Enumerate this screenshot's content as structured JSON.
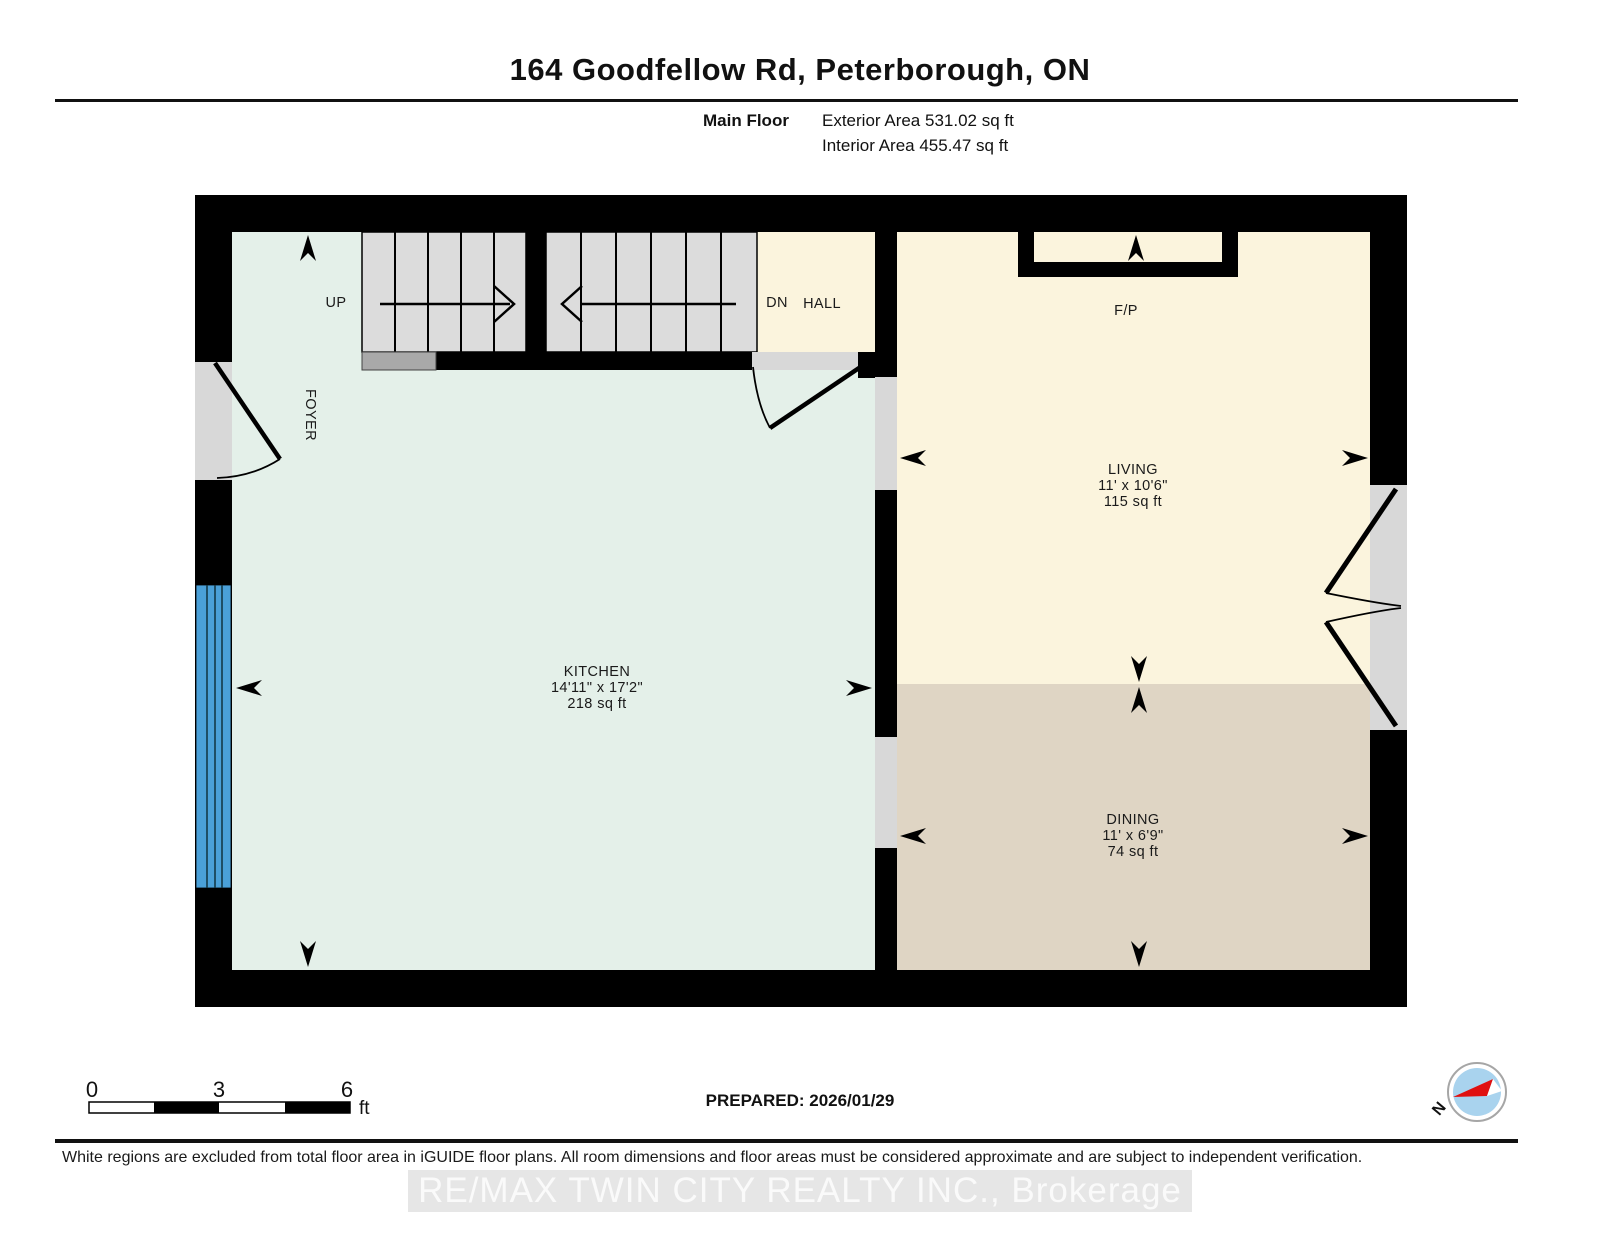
{
  "header": {
    "title": "164 Goodfellow Rd, Peterborough, ON",
    "floor_label": "Main Floor",
    "exterior_area": "Exterior Area 531.02 sq ft",
    "interior_area": "Interior Area 455.47 sq ft"
  },
  "rooms": {
    "kitchen": {
      "label": "KITCHEN",
      "dimensions": "14'11\" x 17'2\"",
      "area": "218 sq ft"
    },
    "living": {
      "label": "LIVING",
      "dimensions": "11' x 10'6\"",
      "area": "115 sq ft"
    },
    "dining": {
      "label": "DINING",
      "dimensions": "11' x 6'9\"",
      "area": "74 sq ft"
    },
    "foyer": {
      "label": "FOYER"
    },
    "hall": {
      "label": "HALL"
    },
    "fireplace": {
      "label": "F/P"
    },
    "stairs": {
      "up_label": "UP",
      "down_label": "DN"
    }
  },
  "scale_bar": {
    "tick_start": "0",
    "tick_mid": "3",
    "tick_end": "6",
    "unit": "ft"
  },
  "prepared_label": "PREPARED: 2026/01/29",
  "compass": {
    "north_label": "N"
  },
  "footer": {
    "disclaimer": "White regions are excluded from total floor area in iGUIDE floor plans. All room dimensions and floor areas must be considered approximate and are subject to independent verification.",
    "watermark": "RE/MAX TWIN CITY REALTY INC., Brokerage"
  },
  "colors": {
    "wall": "#000000",
    "kitchen": "#e4f0e9",
    "living": "#fbf4dd",
    "dining": "#dfd5c4",
    "hall": "#fbf4dd",
    "stairs": "#dcdcdc",
    "opening": "#d8d8d8",
    "step": "#a9a9a9",
    "window": "#4aa0d8",
    "fireplace_inner": "#fbf4dd",
    "compass_inner": "#a9d3ee",
    "compass_needle": "#e01010"
  }
}
